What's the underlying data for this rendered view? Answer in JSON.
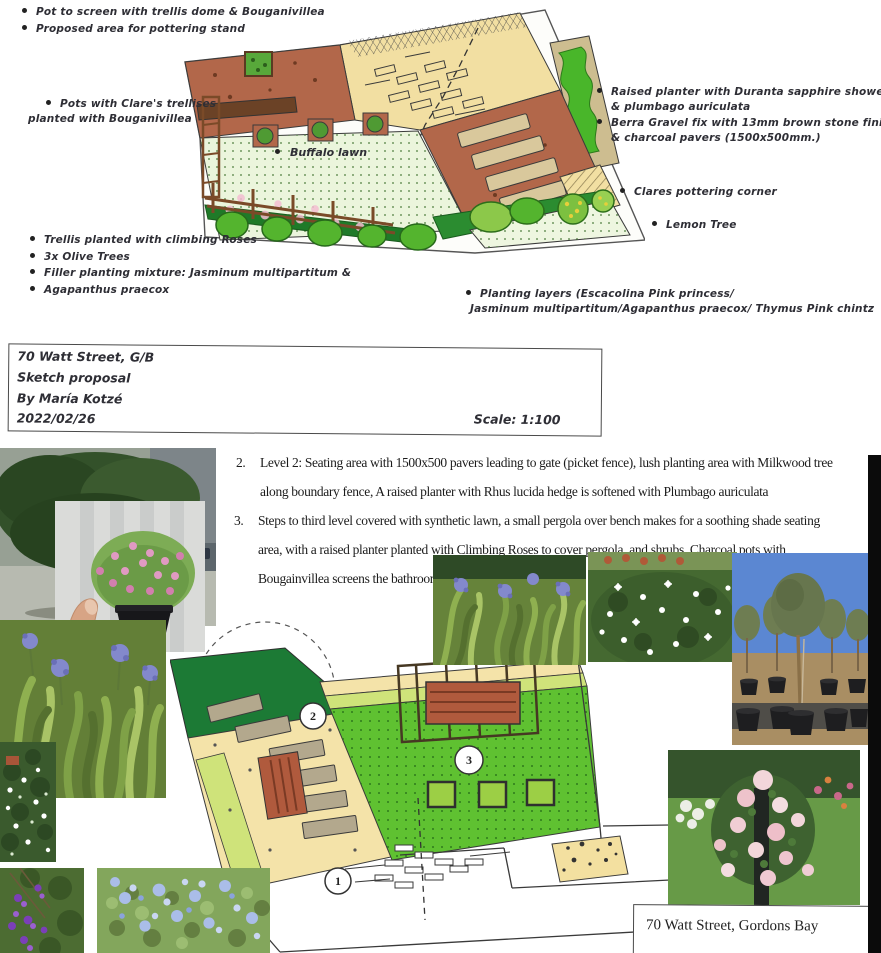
{
  "document": {
    "upper": {
      "annotations": [
        {
          "l1": "Pot to screen with trellis dome & Bouganivillea"
        },
        {
          "l1": "Proposed area for pottering stand"
        },
        {
          "l1": "Pots with Clare's trellises",
          "l2": "planted with Bouganivillea"
        },
        {
          "l1": "Raised planter with Duranta sapphire showers",
          "l2": "& plumbago auriculata"
        },
        {
          "l1": "Berra Gravel fix with 13mm brown stone finish",
          "l2": "& charcoal pavers (1500x500mm.)"
        },
        {
          "l1": "Clares pottering corner"
        },
        {
          "l1": "Lemon Tree"
        },
        {
          "l1": "Trellis planted with climbing Roses"
        },
        {
          "l1": "3x Olive Trees"
        },
        {
          "l1": "Filler planting mixture: Jasminum multipartitum &"
        },
        {
          "l1": "Agapanthus praecox"
        },
        {
          "l1": "Planting layers (Escacolina Pink princess/",
          "l2": "Jasminum multipartitum/Agapanthus praecox/ Thymus Pink chintz"
        }
      ],
      "plan_label": "Buffalo lawn",
      "title_block": {
        "address": "70 Watt Street, G/B",
        "subtitle": "Sketch proposal",
        "author": "By María Kotzé",
        "date": "2022/02/26",
        "scale": "Scale: 1:100"
      }
    },
    "lower": {
      "notes": {
        "item2_num": "2.",
        "item2_lines": [
          "Level 2:  Seating area with 1500x500 pavers leading to gate (picket fence), lush planting area with Milkwood tree",
          "along boundary fence,   A raised planter with Rhus lucida hedge is softened with Plumbago auriculata"
        ],
        "item3_num": "3.",
        "item3_lines": [
          "Steps to third level covered with synthetic lawn, a small pergola over bench makes for a soothing shade seating",
          "area, with a raised planter planted with Climbing Roses to cover pergola, and shrubs.  Charcoal pots with",
          "Bougainvillea screens the bathroom wi"
        ]
      },
      "plan_markers": {
        "m1": "1",
        "m2": "2",
        "m3": "3"
      },
      "caption": "70 Watt Street, Gordons Bay",
      "photos": [
        "milkwood-tree-photo",
        "thymus-pink-chintz-photo",
        "agapanthus-left-photo",
        "jasmine-small-photo",
        "duranta-photo",
        "plumbago-photo",
        "agapanthus-center-photo",
        "jasmine-center-photo",
        "olive-trees-photo",
        "climbing-roses-photo"
      ]
    },
    "colors": {
      "terracotta": "#b2674a",
      "cream_paving": "#f2dfa2",
      "lawn_light": "#ebf5dc",
      "grass_bright": "#5fc131",
      "hedge_dark": "#1c7a35",
      "band_light": "#cfe37a",
      "bench_wood": "#b05a3d",
      "paver_gray": "#b3a88d"
    }
  }
}
